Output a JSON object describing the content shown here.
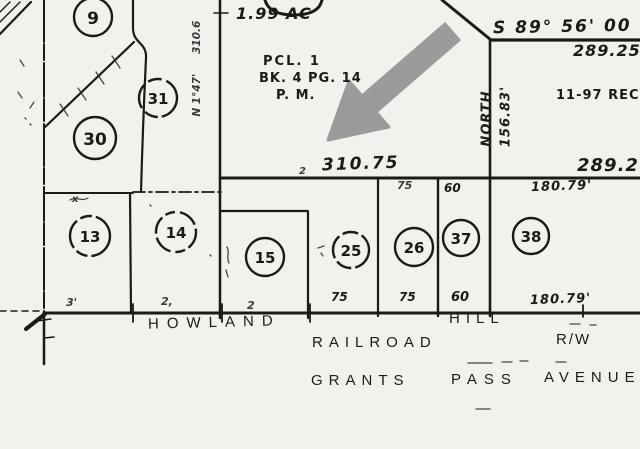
{
  "colors": {
    "ink": "#1c1a17",
    "paper": "#f3f1ed",
    "arrow": "#8d8d8d"
  },
  "parcels": [
    {
      "label": "9"
    },
    {
      "label": "31"
    },
    {
      "label": "30"
    },
    {
      "label": "13"
    },
    {
      "label": "14"
    },
    {
      "label": "15"
    },
    {
      "label": "25"
    },
    {
      "label": "26"
    },
    {
      "label": "37"
    },
    {
      "label": "38"
    }
  ],
  "annotations": {
    "acreage": "1.99 AC",
    "pcl_line1": "PCL. 1",
    "pcl_line2": "BK. 4 PG. 14",
    "pcl_line3": "P. M.",
    "bearing_top": "S 89° 56' 00",
    "dist_top_right": "289.25",
    "record_note": "11-97 REC",
    "north_line_bearing": "NORTH",
    "north_line_dist": "156.83'",
    "dist_mid": "310.75",
    "dist_mid_right": "289.2",
    "dim_180_upper": "180.79'",
    "dim_180_lower": "180.79'",
    "lot_width_60_upper": "60",
    "lot_width_75_upper": "75",
    "lot_width_75_a": "75",
    "lot_width_75_b": "75",
    "lot_width_60_lower": "60",
    "side_bearing": "N 1°47'",
    "side_dist": "310.6",
    "scribble_3": "3'",
    "scribble_2a": "2,",
    "scribble_2b": "2",
    "scribble_2c": "2",
    "scribble_x": "x"
  },
  "streets": {
    "howland": "HOWLAND",
    "hill": "HILL",
    "railroad": "RAILROAD",
    "right_of_way": "R/W",
    "grants": "GRANTS",
    "pass": "PASS",
    "avenue": "AVENUE"
  }
}
